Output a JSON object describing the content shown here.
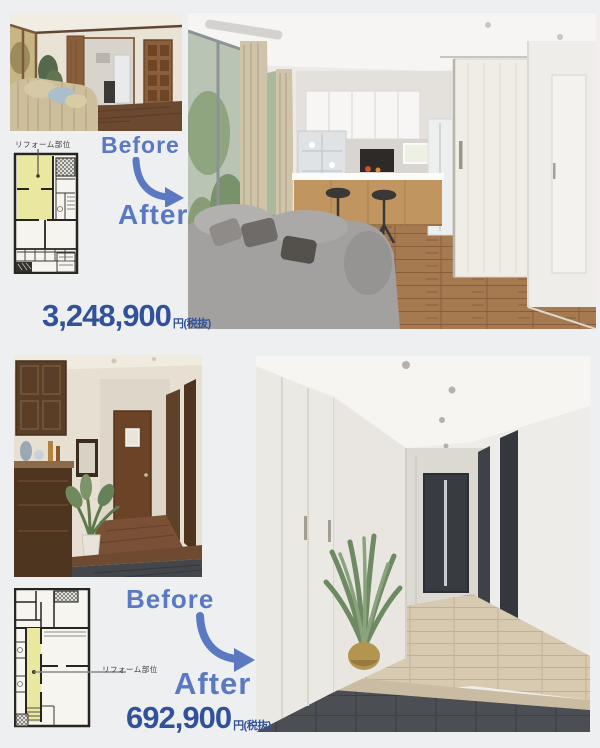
{
  "colors": {
    "background": "#edeff1",
    "before_after_blue": "#5b79c2",
    "price_blue": "#32519b",
    "plan_highlight_yellow": "#eae7a0"
  },
  "section1": {
    "before_label": "Before",
    "after_label": "After",
    "plan_label": "リフォーム部位",
    "price": "3,248,900",
    "price_unit": "円(税抜)"
  },
  "section2": {
    "before_label": "Before",
    "after_label": "After",
    "plan_label": "リフォーム部位",
    "price": "692,900",
    "price_unit": "円(税抜)"
  }
}
